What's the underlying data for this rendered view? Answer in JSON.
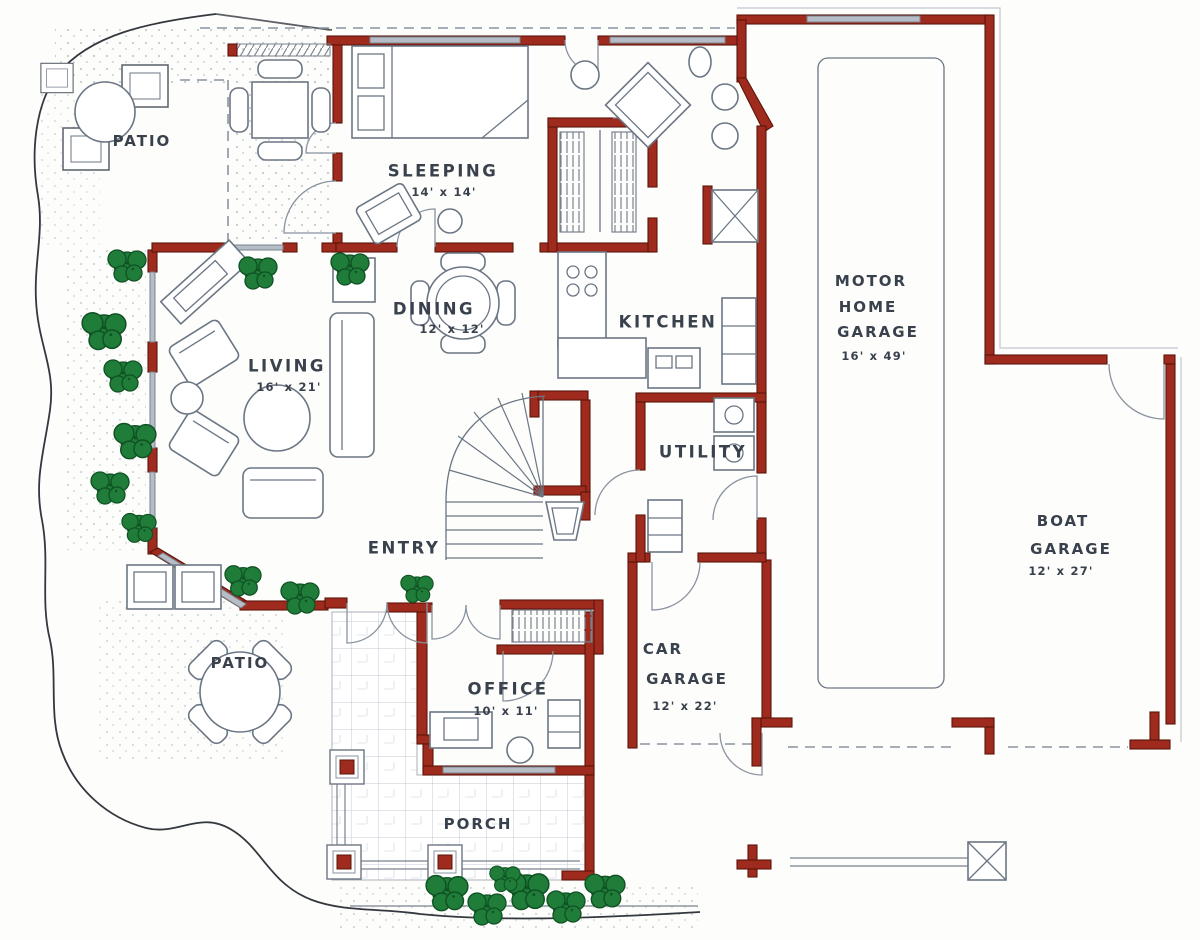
{
  "colors": {
    "wall": "#9e2b1d",
    "ink": "#39414d",
    "line": "#6b7684",
    "shrub": "#1f7c39",
    "shrubDark": "#0f5123",
    "paper": "#fdfdfb"
  },
  "rooms": {
    "patio_upper": {
      "name": "PATIO"
    },
    "sleeping": {
      "name": "SLEEPING",
      "dims": "14' x 14'"
    },
    "dining": {
      "name": "DINING",
      "dims": "12' x 12'"
    },
    "living": {
      "name": "LIVING",
      "dims": "16' x 21'"
    },
    "kitchen": {
      "name": "KITCHEN"
    },
    "utility": {
      "name": "UTILITY"
    },
    "entry": {
      "name": "ENTRY"
    },
    "motor_home_garage": {
      "line1": "MOTOR",
      "line2": "HOME",
      "line3": "GARAGE",
      "dims": "16' x 49'"
    },
    "boat_garage": {
      "line1": "BOAT",
      "line2": "GARAGE",
      "dims": "12' x 27'"
    },
    "car_garage": {
      "line1": "CAR",
      "line2": "GARAGE",
      "dims": "12' x 22'"
    },
    "office": {
      "name": "OFFICE",
      "dims": "10' x 11'"
    },
    "patio_lower": {
      "name": "PATIO"
    },
    "porch": {
      "name": "PORCH"
    }
  }
}
